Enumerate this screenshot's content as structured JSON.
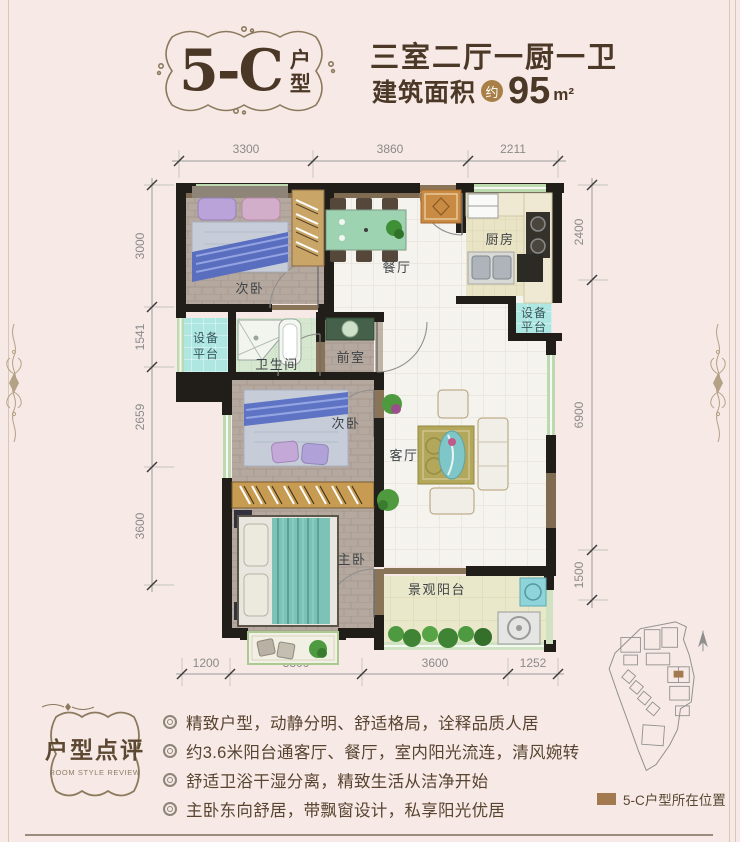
{
  "page": {
    "bg": "#f7e9e5",
    "frame_color": "#d6c7b6",
    "rule_color": "#9a8b7d"
  },
  "header": {
    "unit_code": "5-C",
    "unit_type": "户型",
    "rooms_summary": "三室二厅一厨一卫",
    "area_label": "建筑面积",
    "area_approx_badge": "约",
    "area_value": "95",
    "area_unit": "m²",
    "approx_badge_color": "#a87f47"
  },
  "plan": {
    "dims_top": [
      "3300",
      "3860",
      "2211"
    ],
    "dims_left": [
      "3000",
      "1541",
      "2659",
      "3600"
    ],
    "dims_right": [
      "2400",
      "6900",
      "1500"
    ],
    "dims_bottom": [
      "1200",
      "3300",
      "3600",
      "1252"
    ],
    "rooms": {
      "bedroom_top": "次卧",
      "dining": "餐厅",
      "kitchen": "厨房",
      "equipment_platform_line1": "设备",
      "equipment_platform_line2": "平台",
      "bathroom": "卫生间",
      "foyer": "前室",
      "bedroom_mid": "次卧",
      "living": "客厅",
      "master_bedroom": "主卧",
      "balcony": "景观阳台"
    }
  },
  "review": {
    "badge_title": "户型点评",
    "badge_subtitle": "ROOM STYLE REVIEW",
    "bullets": [
      "精致户型，动静分明、舒适格局，诠释品质人居",
      "约3.6米阳台通客厅、餐厅，室内阳光流连，清风婉转",
      "舒适卫浴干湿分离，精致生活从洁净开始",
      "主卧东向舒居，带飘窗设计，私享阳光优居"
    ]
  },
  "siteplan": {
    "legend_label": "5-C户型所在位置",
    "marker_color": "#a3794f"
  }
}
